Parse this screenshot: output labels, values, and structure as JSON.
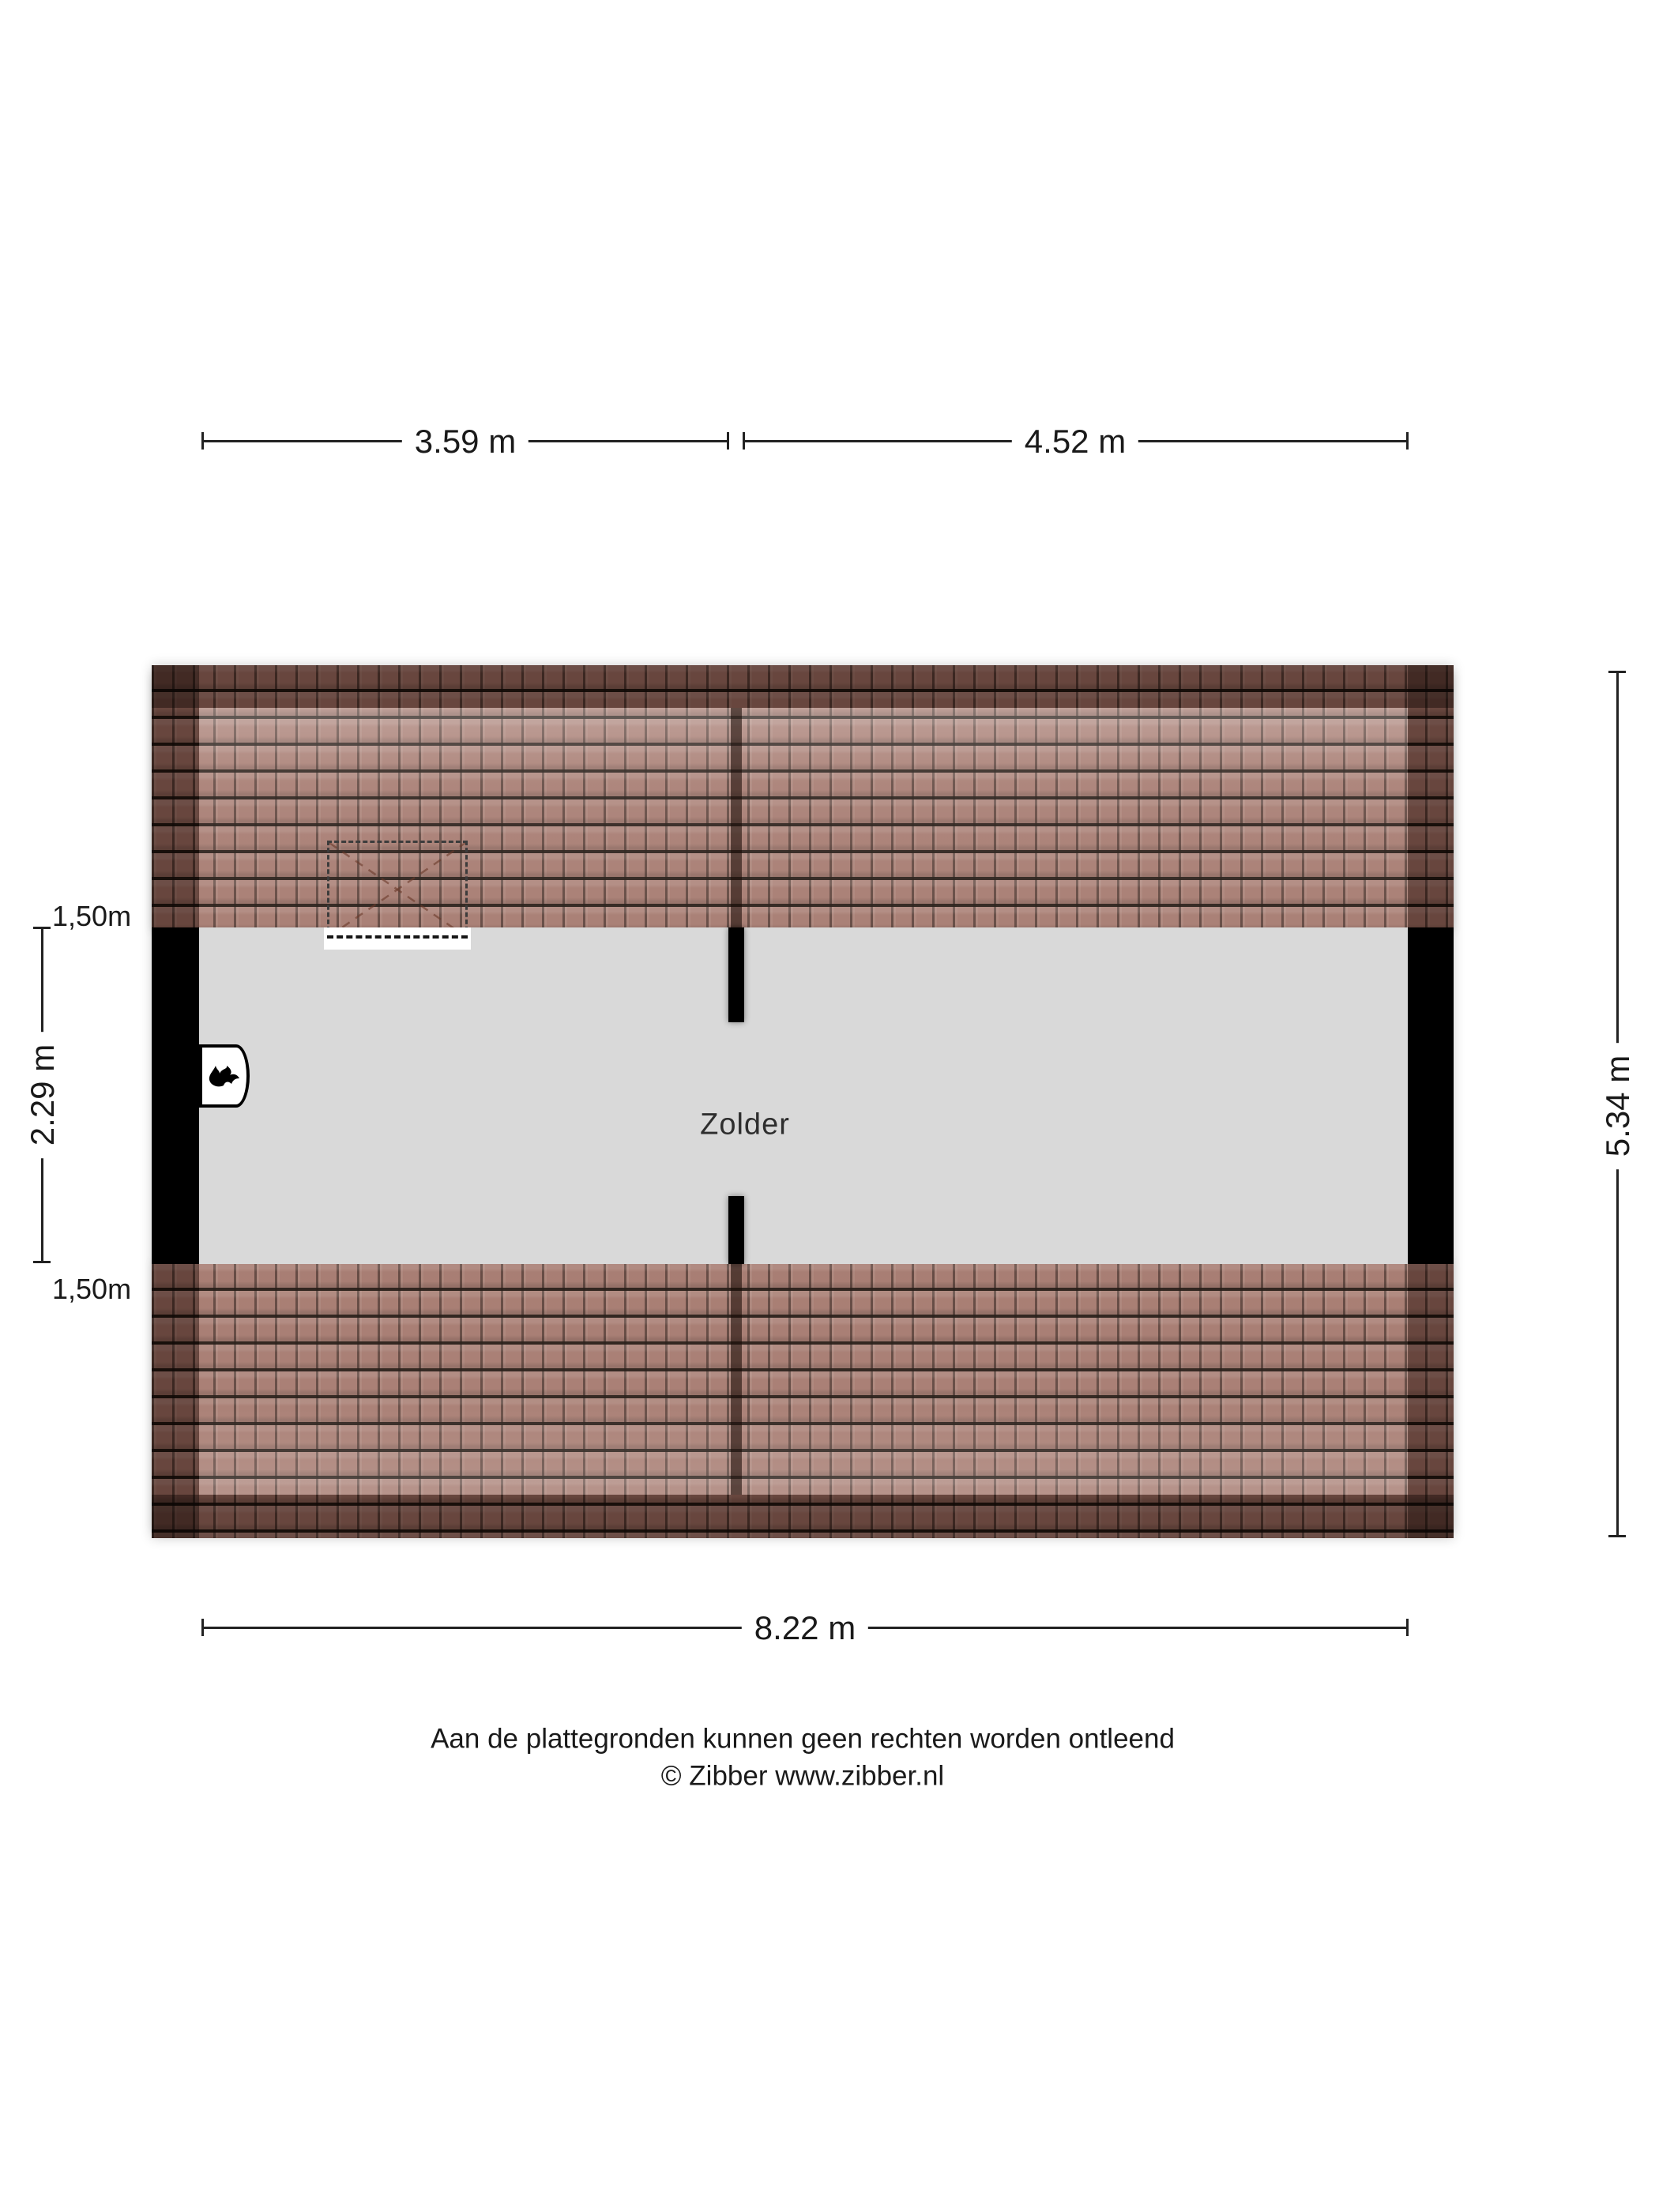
{
  "room": {
    "label": "Zolder"
  },
  "dimensions": {
    "top_left_width": "3.59 m",
    "top_right_width": "4.52 m",
    "left_upper_band": "1,50m",
    "left_middle_height": "2.29 m",
    "left_lower_band": "1,50m",
    "right_total_height": "5.34 m",
    "bottom_total_width": "8.22 m"
  },
  "footer": {
    "disclaimer": "Aan de plattegronden kunnen geen rechten worden ontleend",
    "credit": "© Zibber www.zibber.nl"
  },
  "icons": {
    "boiler": "flame-icon",
    "roof_window": "dashed-roof-window"
  },
  "colors": {
    "floor": "#d9d9d9",
    "tile_base": "#a3766b",
    "roof_dark": "rgba(48,25,16,0.45)",
    "wall": "#000000",
    "dimension": "#222222",
    "text": "#1a1a1a"
  }
}
